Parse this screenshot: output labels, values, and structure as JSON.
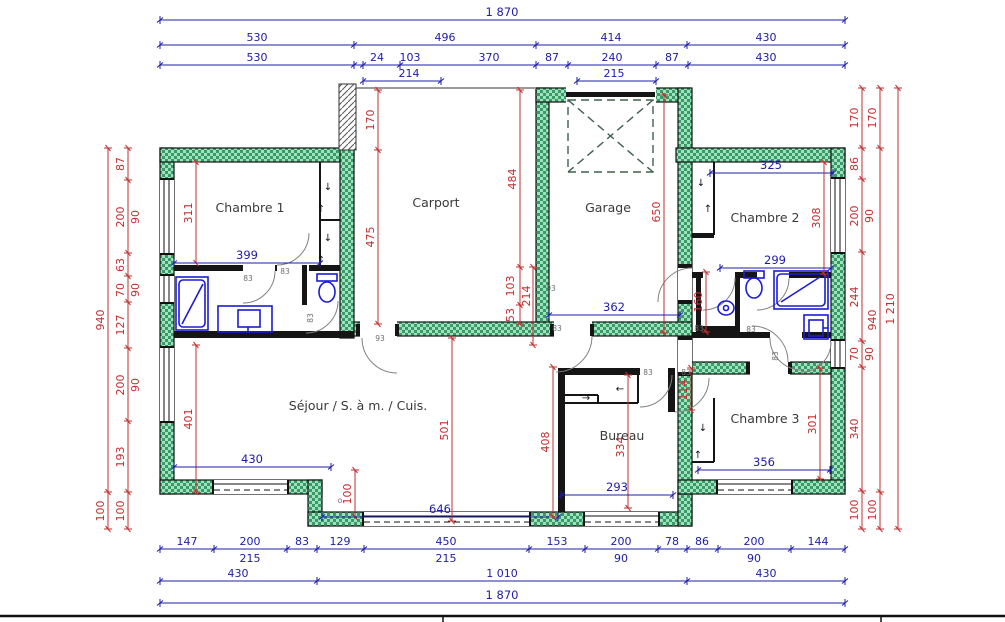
{
  "colors": {
    "dim_blue": "#1c1ca8",
    "dim_red": "#c22f2f",
    "wall_green_light": "#9fe2c0",
    "wall_green_dark": "#3a9a66",
    "fixture_blue": "#1b1bd4",
    "door_arc_gray": "#828282"
  },
  "rooms": {
    "chambre1": "Chambre 1",
    "carport": "Carport",
    "garage": "Garage",
    "chambre2": "Chambre 2",
    "sejour": "Séjour / S. à m. / Cuis.",
    "bureau": "Bureau",
    "chambre3": "Chambre 3"
  },
  "top": {
    "total": "1 870",
    "row2": [
      "530",
      "496",
      "414",
      "430"
    ],
    "row3": [
      "530",
      "24",
      "103",
      "370",
      "87",
      "240",
      "87",
      "430"
    ],
    "sub": [
      "214",
      "215"
    ]
  },
  "bottom": {
    "row1": [
      "147",
      "200",
      "83",
      "129",
      "450",
      "153",
      "200",
      "78",
      "86",
      "200",
      "144"
    ],
    "sub": [
      "215",
      "215",
      "90",
      "90"
    ],
    "row2": [
      "430",
      "1 010",
      "430"
    ],
    "total": "1 870"
  },
  "left": {
    "segs": [
      "87",
      "200",
      "63",
      "70",
      "127",
      "200",
      "193"
    ],
    "win": [
      "90",
      "90",
      "90"
    ],
    "outer": "940",
    "low": [
      "100",
      "100"
    ]
  },
  "right": {
    "segs": [
      "170",
      "86",
      "200",
      "244",
      "70",
      "340"
    ],
    "win": [
      "90",
      "90"
    ],
    "low": "100",
    "mid": [
      "170",
      "940",
      "100"
    ],
    "outer": "1 210"
  },
  "interior": {
    "c1_h": "311",
    "c1_w": "399",
    "carport_top": "170",
    "carport_h": "475",
    "mid_h": "484",
    "mid_103": "103",
    "mid_214": "214",
    "mid_53": "53",
    "garage_h": "650",
    "hall_w": "362",
    "c2_w": "325",
    "c2_h": "308",
    "bath2_w": "299",
    "bath2_h": "160",
    "sejour_h": "401",
    "sejour_w": "430",
    "sejour_mid": "501",
    "jog_h": "100",
    "sejour_w2": "646",
    "bureau_wl": "408",
    "bureau_h": "334",
    "bureau_w": "293",
    "closet_w": "114",
    "c3_h": "301",
    "c3_w": "356"
  },
  "labels": {
    "door83": "83",
    "door93": "93",
    "circle": "o"
  },
  "icons": {
    "arrow_up": "↑",
    "arrow_down": "↓",
    "arrow_left": "←",
    "arrow_right": "→"
  }
}
